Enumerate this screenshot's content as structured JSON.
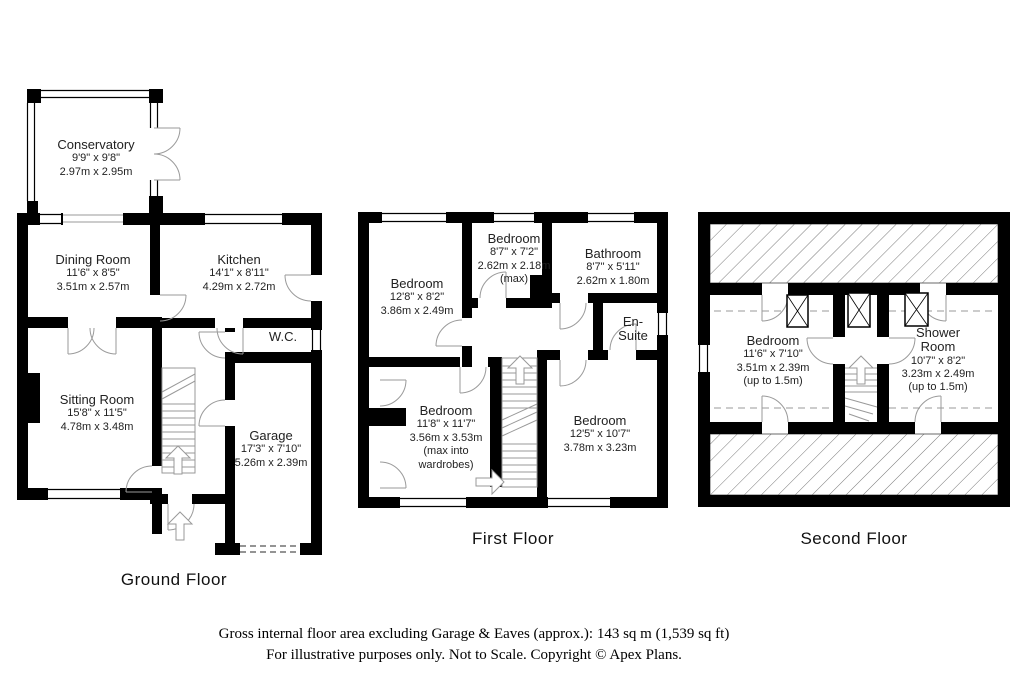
{
  "title": "Apex Plans property floor plan",
  "floors": {
    "ground": {
      "label": "Ground Floor",
      "rooms": {
        "conservatory": {
          "name": "Conservatory",
          "imperial": "9'9\" x 9'8\"",
          "metric": "2.97m x 2.95m"
        },
        "dining_room": {
          "name": "Dining Room",
          "imperial": "11'6\" x 8'5\"",
          "metric": "3.51m x 2.57m"
        },
        "kitchen": {
          "name": "Kitchen",
          "imperial": "14'1\" x 8'11\"",
          "metric": "4.29m x 2.72m"
        },
        "wc": {
          "name": "W.C."
        },
        "sitting_room": {
          "name": "Sitting Room",
          "imperial": "15'8\" x 11'5\"",
          "metric": "4.78m x 3.48m"
        },
        "garage": {
          "name": "Garage",
          "imperial": "17'3\" x 7'10\"",
          "metric": "5.26m x 2.39m"
        }
      }
    },
    "first": {
      "label": "First Floor",
      "rooms": {
        "bedroom_1": {
          "name": "Bedroom",
          "imperial": "12'8\" x 8'2\"",
          "metric": "3.86m x 2.49m"
        },
        "bedroom_2": {
          "name": "Bedroom",
          "imperial": "8'7\" x 7'2\"",
          "metric": "2.62m x 2.18m",
          "note": "(max)"
        },
        "bathroom": {
          "name": "Bathroom",
          "imperial": "8'7\" x 5'11\"",
          "metric": "2.62m x 1.80m"
        },
        "en_suite": {
          "name": "En-Suite"
        },
        "bedroom_3": {
          "name": "Bedroom",
          "imperial": "11'8\" x 11'7\"",
          "metric": "3.56m x 3.53m",
          "note": "(max into wardrobes)"
        },
        "bedroom_4": {
          "name": "Bedroom",
          "imperial": "12'5\" x 10'7\"",
          "metric": "3.78m x 3.23m"
        }
      }
    },
    "second": {
      "label": "Second Floor",
      "rooms": {
        "bedroom_5": {
          "name": "Bedroom",
          "imperial": "11'6\" x 7'10\"",
          "metric": "3.51m x 2.39m",
          "note": "(up to 1.5m)"
        },
        "shower_room": {
          "name": "Shower Room",
          "imperial": "10'7\" x 8'2\"",
          "metric": "3.23m x 2.49m",
          "note": "(up to 1.5m)"
        }
      }
    }
  },
  "footer": {
    "line1": "Gross internal floor area excluding Garage & Eaves (approx.): 143 sq m (1,539 sq ft)",
    "line2": "For illustrative purposes only. Not to Scale. Copyright © Apex Plans."
  },
  "colors": {
    "wall": "#000000",
    "door_arc": "#9a9a9a",
    "hatch": "#7a7a7a",
    "background": "#ffffff"
  }
}
